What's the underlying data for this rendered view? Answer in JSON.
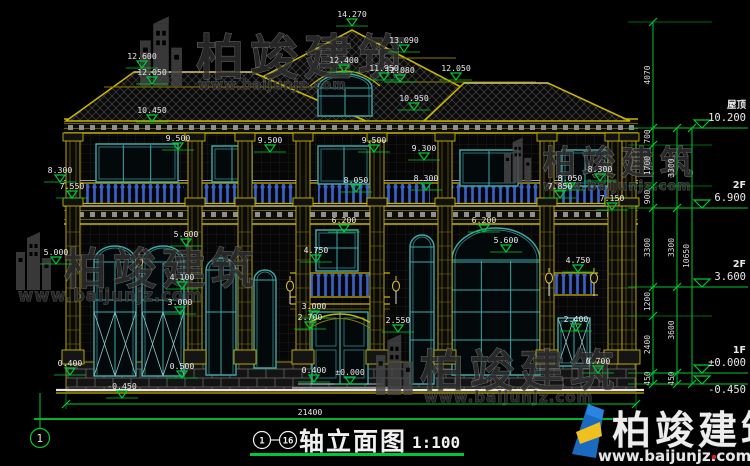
{
  "colors": {
    "dim_green": "#00c832",
    "structure_yellow": "#c8b400",
    "window_teal": "#3fa8a8",
    "balustrade_blue": "#3a62c8",
    "text_white": "#e9e9e9",
    "logo_blue": "#1a6bc0",
    "logo_yellow": "#f0c020",
    "logo_red_dot": "#cc2222"
  },
  "watermark": {
    "brand": "柏竣建筑",
    "url": "www.baijunjz.com"
  },
  "title_block": {
    "axis_start": "1",
    "axis_end": "16",
    "name": "轴立面图",
    "scale": "1:100"
  },
  "axis_bubble": "1",
  "overall_width_dim": "21400",
  "levels": [
    {
      "label": "屋顶",
      "value": "10.200",
      "y": 128
    },
    {
      "label": "2F",
      "value": "6.900",
      "y": 208
    },
    {
      "label": "2F",
      "value": "3.600",
      "y": 287
    },
    {
      "label": "1F",
      "value": "±0.000",
      "y": 373
    },
    {
      "label": "",
      "value": "-0.450",
      "y": 384
    }
  ],
  "dim_chains": [
    {
      "x": 653,
      "boundaries": [
        22,
        128,
        145,
        186,
        208,
        287,
        316,
        373,
        384
      ],
      "labels": [
        "4070",
        "700",
        "1700",
        "900",
        "3300",
        "1200",
        "2400",
        "450"
      ]
    },
    {
      "x": 677,
      "boundaries": [
        128,
        208,
        287,
        373,
        384
      ],
      "labels": [
        "3300",
        "3300",
        "3600",
        "450"
      ]
    }
  ],
  "dim_total": {
    "x": 692,
    "y1": 128,
    "y2": 384,
    "label": "10650"
  },
  "elevation_markers": [
    {
      "v": "14.270",
      "x": 352,
      "y": 26
    },
    {
      "v": "13.090",
      "x": 404,
      "y": 52
    },
    {
      "v": "12.600",
      "x": 142,
      "y": 68
    },
    {
      "v": "12.400",
      "x": 344,
      "y": 72
    },
    {
      "v": "12.080",
      "x": 400,
      "y": 82
    },
    {
      "v": "12.050",
      "x": 152,
      "y": 84
    },
    {
      "v": "12.050",
      "x": 456,
      "y": 80
    },
    {
      "v": "11.950",
      "x": 384,
      "y": 80
    },
    {
      "v": "10.950",
      "x": 414,
      "y": 110
    },
    {
      "v": "10.450",
      "x": 152,
      "y": 122
    },
    {
      "v": "9.500",
      "x": 178,
      "y": 150
    },
    {
      "v": "9.500",
      "x": 270,
      "y": 152
    },
    {
      "v": "9.500",
      "x": 374,
      "y": 152
    },
    {
      "v": "9.300",
      "x": 424,
      "y": 160
    },
    {
      "v": "8.300",
      "x": 60,
      "y": 182
    },
    {
      "v": "8.300",
      "x": 426,
      "y": 190
    },
    {
      "v": "8.300",
      "x": 600,
      "y": 181
    },
    {
      "v": "8.050",
      "x": 356,
      "y": 192
    },
    {
      "v": "8.050",
      "x": 570,
      "y": 190
    },
    {
      "v": "7.850",
      "x": 560,
      "y": 198
    },
    {
      "v": "7.550",
      "x": 72,
      "y": 198
    },
    {
      "v": "7.150",
      "x": 612,
      "y": 210
    },
    {
      "v": "6.200",
      "x": 344,
      "y": 232
    },
    {
      "v": "6.200",
      "x": 484,
      "y": 232
    },
    {
      "v": "5.600",
      "x": 186,
      "y": 246
    },
    {
      "v": "5.600",
      "x": 506,
      "y": 252
    },
    {
      "v": "5.000",
      "x": 56,
      "y": 264
    },
    {
      "v": "4.750",
      "x": 316,
      "y": 262
    },
    {
      "v": "4.750",
      "x": 578,
      "y": 272
    },
    {
      "v": "4.100",
      "x": 182,
      "y": 289
    },
    {
      "v": "3.000",
      "x": 180,
      "y": 314
    },
    {
      "v": "3.000",
      "x": 314,
      "y": 318
    },
    {
      "v": "2.700",
      "x": 310,
      "y": 329
    },
    {
      "v": "2.550",
      "x": 398,
      "y": 332
    },
    {
      "v": "2.400",
      "x": 576,
      "y": 331
    },
    {
      "v": "0.400",
      "x": 70,
      "y": 375
    },
    {
      "v": "0.400",
      "x": 314,
      "y": 382
    },
    {
      "v": "0.500",
      "x": 182,
      "y": 378
    },
    {
      "v": "0.700",
      "x": 598,
      "y": 373
    },
    {
      "v": "-0.450",
      "x": 122,
      "y": 398
    },
    {
      "v": "±0.000",
      "x": 350,
      "y": 384
    }
  ]
}
